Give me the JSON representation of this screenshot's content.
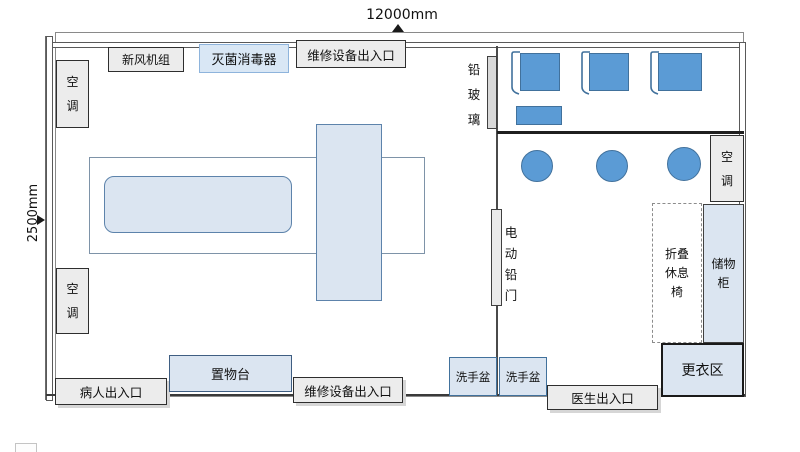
{
  "canvas": {
    "width_px": 800,
    "height_px": 452,
    "background": "#ffffff"
  },
  "dimensions": {
    "room_width": "12000mm",
    "room_depth": "2500mm"
  },
  "labels": {
    "fresh_air_unit": "新风机组",
    "sterilizer": "灭菌消毒器",
    "maintenance_access_top": "维修设备出入口",
    "air_conditioner": "空调",
    "lead_glass": "铅玻璃",
    "electric_lead_door": "电动铅门",
    "folding_rest_chair": "折叠休息椅",
    "storage_cabinet": "储物柜",
    "changing_area": "更衣区",
    "doctor_access": "医生出入口",
    "wash_basin": "洗手盆",
    "maintenance_access_bottom": "维修设备出入口",
    "shelf_counter": "置物台",
    "patient_access": "病人出入口"
  },
  "shapes": {
    "ct_table": "scan-bed-rounded-rect",
    "ct_gantry": "gantry-rect",
    "workstations": 3,
    "operator_stools": 3,
    "monitor_side_table": 1
  },
  "colors": {
    "solid_blue": "#5b9bd5",
    "solid_blue_border": "#41719c",
    "light_blue_fill": "#dbe5f1",
    "sterilizer_fill": "#d9e7f5",
    "sterilizer_border": "#8eb4dc",
    "gray_fill": "#ececec",
    "wall_line": "#404040",
    "dim_line": "#6b6b6b"
  }
}
